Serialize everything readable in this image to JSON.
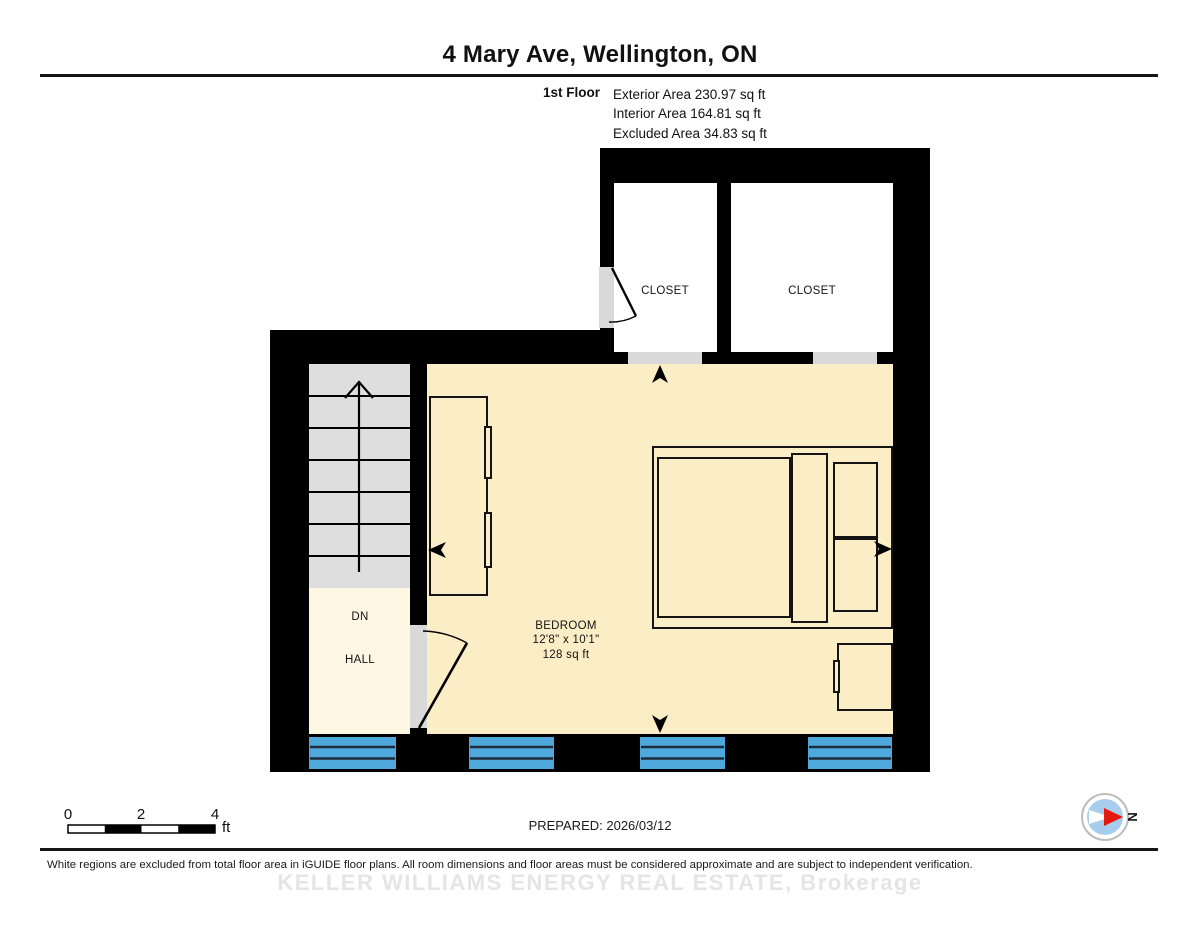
{
  "header": {
    "title": "4 Mary Ave, Wellington, ON",
    "floor_label": "1st Floor",
    "stats": [
      "Exterior Area 230.97 sq ft",
      "Interior Area 164.81 sq ft",
      "Excluded Area 34.83 sq ft"
    ]
  },
  "plan": {
    "rooms": {
      "closet_left": "CLOSET",
      "closet_right": "CLOSET",
      "bedroom": {
        "name": "BEDROOM",
        "dimensions": "12'8\" x 10'1\"",
        "area": "128 sq ft"
      },
      "stairs_direction": "DN",
      "hall": "HALL"
    },
    "colors": {
      "wall": "#000000",
      "bedroom_floor": "#FBEEC6",
      "hall_floor": "#FCF6E2",
      "excluded_floor": "#FFFFFF",
      "stairs": "#DEDEDE",
      "door_opening": "#D9D9D9",
      "window_blue": "#4FA8DB",
      "compass_blue": "#A7CDEC",
      "compass_red": "#E41A0F"
    }
  },
  "footer": {
    "scale": {
      "ticks": [
        "0",
        "2",
        "4"
      ],
      "unit": "ft"
    },
    "prepared": "PREPARED: 2026/03/12",
    "compass_label": "N",
    "disclaimer": "White regions are excluded from total floor area in iGUIDE floor plans. All room dimensions and floor areas must be considered approximate and are subject to independent verification.",
    "watermark": "KELLER WILLIAMS ENERGY REAL ESTATE, Brokerage"
  }
}
